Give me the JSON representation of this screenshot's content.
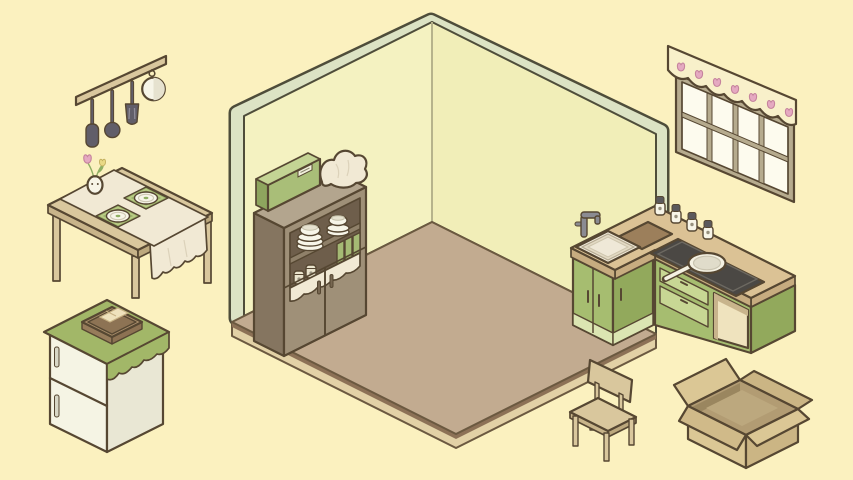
{
  "scene": {
    "title": "Cozy isometric kitchen room with furniture waiting to be placed",
    "style": "pastel cartoon decorating game"
  },
  "room": {
    "name": "empty room corner",
    "walls": 2,
    "floor": "wooden platform"
  },
  "objects": {
    "utensil_rack": {
      "name": "hanging utensil rack",
      "items": [
        "flat spatula",
        "ladle",
        "slotted turner",
        "small white pot"
      ]
    },
    "dining_table": {
      "name": "wooden dining table",
      "items": [
        "lace-edged table runner",
        "green placemat with plate",
        "green placemat with plate",
        "bunny-face vase with pink and yellow tulips"
      ]
    },
    "refrigerator": {
      "name": "two-door refrigerator",
      "items": [
        "green scalloped cover cloth",
        "basket with bread"
      ],
      "handles": 2
    },
    "cupboard": {
      "name": "tall kitchen cupboard",
      "items": [
        "green storage box",
        "folded white cloth",
        "plate stack",
        "bowl stack",
        "green books",
        "jars",
        "white lace shelf cloth"
      ],
      "doors": 2
    },
    "kitchen_counter": {
      "name": "L-shaped kitchen counter",
      "items": [
        "sink",
        "faucet",
        "cutting board",
        "spice jars",
        "black cooktop",
        "white frying pan",
        "drawers",
        "open shelf"
      ],
      "spice_jar_count": 4
    },
    "window": {
      "name": "window with tulip valance",
      "pane_count": 8,
      "tulip_motif_count": 7
    },
    "chair": {
      "name": "wooden chair",
      "legs": 4
    },
    "cardboard_box": {
      "name": "open cardboard box",
      "flaps": 4
    }
  },
  "colors": {
    "bg": "#FBF1BF",
    "ink": "#564732",
    "wall": "#F4F2C1",
    "wall2": "#F1EEB8",
    "wall_trim": "#DCE3C4",
    "wall_line": "#4E4D3A",
    "wall_corner": "#D9D5A6",
    "floor_top": "#C2AB90",
    "floor_edge": "#8C7156",
    "floor_side": "#E2D1A6",
    "floor_line": "#6B5940",
    "wood": "#D9C79D",
    "wood_side": "#C8B48A",
    "wood_side2": "#BCA87D",
    "cloth": "#F1E9D4",
    "cloth_sh": "#DCD2BA",
    "white": "#F7F5E8",
    "white_sh": "#E6E2CF",
    "ring": "#CFC9B4",
    "placemat": "#9CB26A",
    "placemat_in": "#BCCD86",
    "leaf": "#8FAF63",
    "tulip_pink": "#E5A9C1",
    "tulip_pink_dk": "#C5839D",
    "tulip_yellow": "#E9D985",
    "tulip_yellow_dk": "#C2AF5D",
    "utensil": "#615E69",
    "utensil_hl": "#8E8B97",
    "steel": "#8B8B92",
    "fridge": "#F5F4E4",
    "fridge_side": "#E9E7D4",
    "fridge_cloth": "#A2B768",
    "fridge_handle": "#D8D7C6",
    "basket": "#A98E6B",
    "basket_dk": "#8D7354",
    "basket_w1": "#977C5B",
    "basket_w2": "#8D7253",
    "bread": "#EFE2BD",
    "bread_line": "#C8B285",
    "taupe": "#9F9078",
    "taupe_side": "#857560",
    "taupe_top": "#B3A58E",
    "taupe_deep": "#6E5E4B",
    "taupe_board": "#8F8069",
    "handle_dk": "#776751",
    "book": "#A5BA74",
    "jar": "#EAE4CD",
    "green_box": "#A9BE78",
    "green_box_top": "#C4D494",
    "green_box_side": "#8EA55E",
    "box_label": "#F1F1DC",
    "label_str": "#8C8870",
    "counter_top": "#DBC295",
    "counter_side": "#C7AC80",
    "cab": "#A6BD70",
    "cab_dk": "#92A95C",
    "cab_lt": "#C8D794",
    "cab_pale": "#DBE5B2",
    "cubby": "#EFE3BE",
    "cubby_sh": "#C8B48C",
    "stove": "#4B4844",
    "stove_edge": "#6D6961",
    "pan": "#F4F1E2",
    "pan_in": "#E0DCCA",
    "pan_str": "#C9C4B0",
    "board": "#9C7F5B",
    "sink_rim": "#F0EAD9",
    "sink_mid": "#E3DAC4",
    "sink_str": "#B5AA92",
    "sink_in": "#EFE8D7",
    "sink_in_str": "#CEC5AD",
    "bowl_str": "#C6C1AA",
    "jar_lid": "#5B595C",
    "dot": "#97917F",
    "frame": "#B6AB8E",
    "pane": "#FDFBEE",
    "valance": "#F8F0CA",
    "card": "#DBC795",
    "card_side": "#CBB584",
    "card_dk": "#D0BA89",
    "card_in": "#B29C73",
    "card_deep": "#9A865F",
    "card_floor": "#BCA87E"
  }
}
